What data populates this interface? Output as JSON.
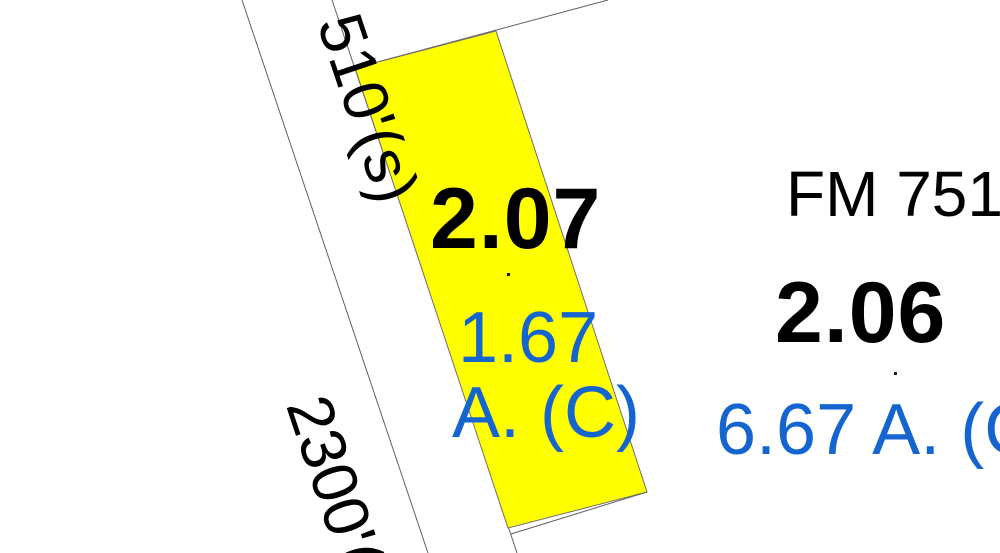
{
  "canvas": {
    "width": 1000,
    "height": 553,
    "background": "#ffffff"
  },
  "road": {
    "name_label": "FM 751",
    "dimension_label_upper": "510'(s)",
    "dimension_label_lower": "2300'("
  },
  "parcels": {
    "p207": {
      "id": "2.07",
      "acreage_line1": "1.67",
      "acreage_line2": "A. (C)",
      "highlight": "#ffff00",
      "highlighted": true
    },
    "p206": {
      "id": "2.06",
      "acreage": "6.67 A. (C",
      "highlighted": false
    }
  },
  "colors": {
    "parcel_id_text": "#000000",
    "acreage_text": "#1565d1",
    "boundary_line": "#606060",
    "highlight_fill": "#ffff00",
    "point_marker": "#1a1a1a"
  }
}
